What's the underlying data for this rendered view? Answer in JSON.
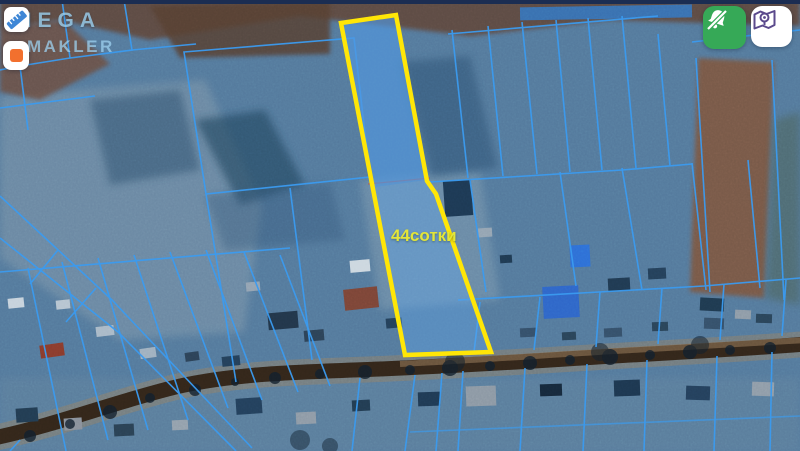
{
  "watermark": {
    "line1": "MEGA",
    "line2": "MAKLER"
  },
  "plot": {
    "label": "44сотки",
    "area_sotki": 44,
    "unit": "сотки",
    "outline_color": "#ffe607",
    "label_color": "#e3e539",
    "fill_color": "rgba(96,168,240,0.38)",
    "polygon": [
      [
        341,
        23
      ],
      [
        396,
        15
      ],
      [
        427,
        181
      ],
      [
        436,
        194
      ],
      [
        491,
        352
      ],
      [
        405,
        355
      ]
    ]
  },
  "controls": {
    "left": [
      {
        "name": "measure-tool",
        "icon": "ruler-icon",
        "accent": "#3f87d6"
      },
      {
        "name": "shape-tool",
        "icon": "orange-square-icon",
        "accent": "#f2702e"
      }
    ],
    "right": [
      {
        "name": "hide-markers",
        "icon": "bell-slash-icon",
        "bg": "#36a957"
      },
      {
        "name": "map-mode",
        "icon": "map-pin-icon",
        "accent": "#5b4a8c"
      }
    ]
  },
  "map_colors": {
    "base": "#54799c",
    "cadastral_line": "#3b9bf0",
    "road": "#33261a",
    "water_overlay": "#2e7cd4",
    "boundary_red": "#cc4a3a"
  }
}
